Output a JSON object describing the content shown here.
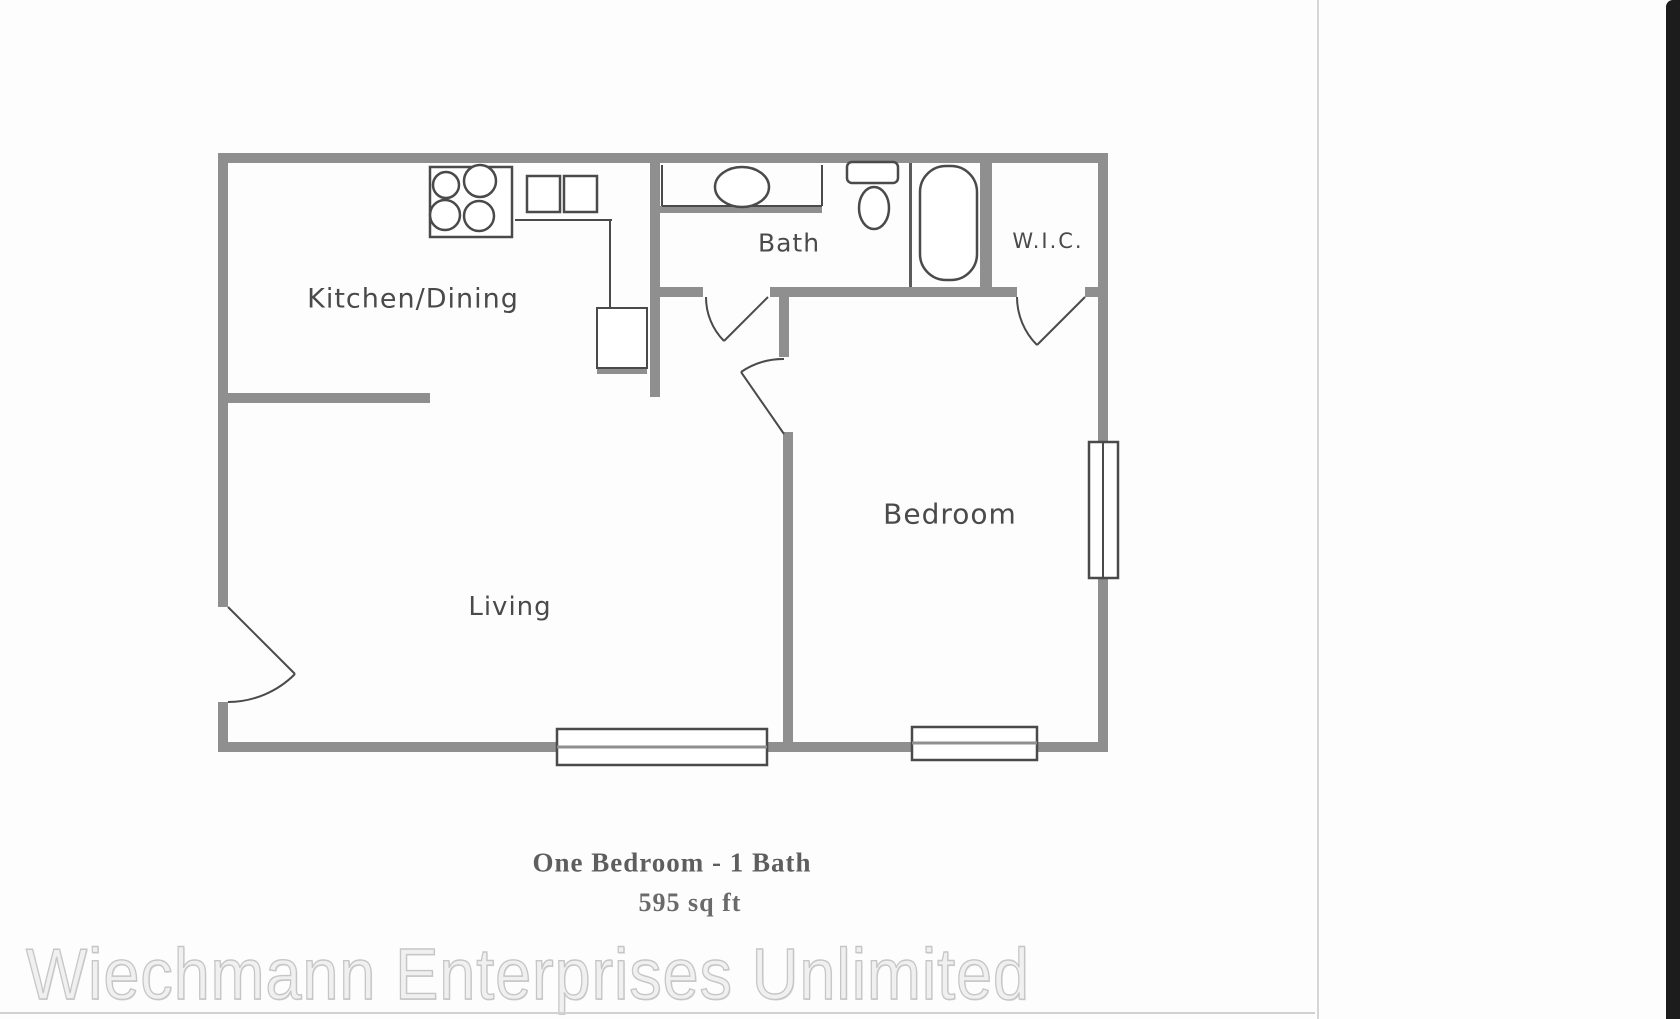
{
  "document": {
    "plan_title": "One Bedroom - 1 Bath",
    "plan_area": "595 sq ft",
    "watermark": "Wiechmann Enterprises Unlimited"
  },
  "rooms": {
    "kitchen_dining": "Kitchen/Dining",
    "bath": "Bath",
    "wic": "W.I.C.",
    "living": "Living",
    "bedroom": "Bedroom"
  },
  "fixtures": {
    "stove": "stove-burners-icon",
    "kitchen_sink": "double-sink-icon",
    "bath_sink": "vanity-sink-icon",
    "toilet": "toilet-icon",
    "bathtub": "bathtub-icon",
    "windows": [
      "living-window",
      "bedroom-south-window",
      "bedroom-east-window"
    ],
    "doors": [
      "entry-door",
      "bath-door",
      "bedroom-door",
      "wic-door"
    ]
  },
  "colors": {
    "wall_gray": "#8f8f8f",
    "line_gray": "#4a4a4a",
    "label_gray": "#4a4a4a",
    "caption_gray": "#5e5e5e",
    "watermark_gray": "#f0f0f0",
    "scan_edge_black": "#1c1c1c"
  }
}
